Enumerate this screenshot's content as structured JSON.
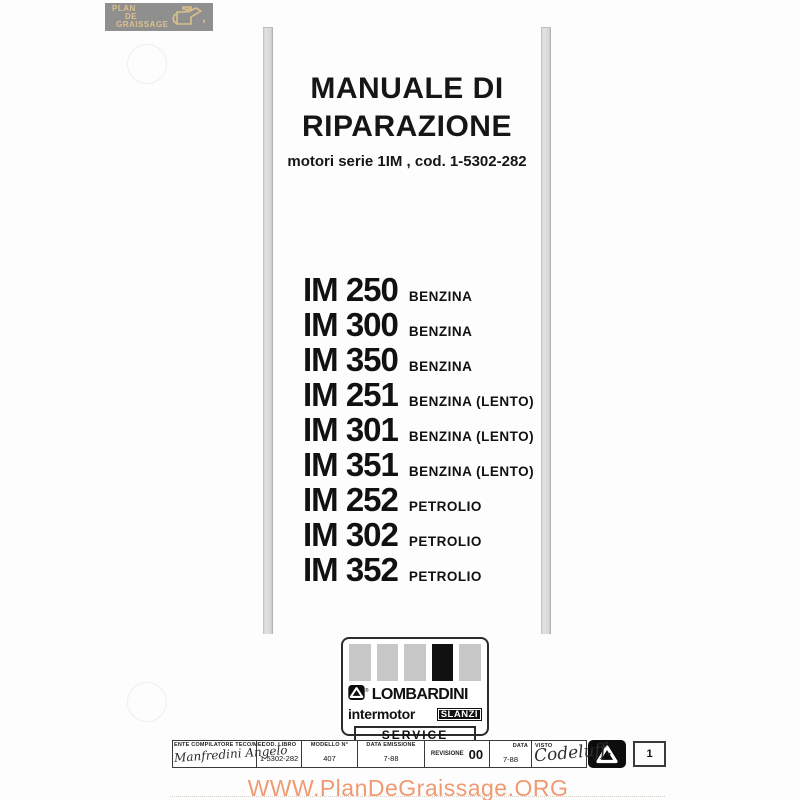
{
  "corner_badge": {
    "line1": "PLAN",
    "line2": "DE",
    "line3": "GRAISSAGE",
    "bg_color": "#8f8f8f",
    "text_color": "#dcc18c",
    "icon": "oil-can-icon"
  },
  "title": {
    "line1": "MANUALE DI",
    "line2": "RIPARAZIONE",
    "subtitle": "motori serie 1IM , cod. 1-5302-282"
  },
  "models": [
    {
      "name": "IM 250",
      "fuel": "BENZINA"
    },
    {
      "name": "IM 300",
      "fuel": "BENZINA"
    },
    {
      "name": "IM 350",
      "fuel": "BENZINA"
    },
    {
      "name": "IM 251",
      "fuel": "BENZINA (LENTO)"
    },
    {
      "name": "IM 301",
      "fuel": "BENZINA (LENTO)"
    },
    {
      "name": "IM 351",
      "fuel": "BENZINA (LENTO)"
    },
    {
      "name": "IM 252",
      "fuel": "PETROLIO"
    },
    {
      "name": "IM 302",
      "fuel": "PETROLIO"
    },
    {
      "name": "IM 352",
      "fuel": "PETROLIO"
    }
  ],
  "brand_block": {
    "brand": "LOMBARDINI",
    "registered": "®",
    "left_brand": "intermotor",
    "right_brand": "SLANZI",
    "service": "SERVICE",
    "bar_colors": [
      "#c7c7c7",
      "#c7c7c7",
      "#c7c7c7",
      "#111111",
      "#c7c7c7"
    ]
  },
  "footer_table": {
    "ente": {
      "label": "ENTE COMPILATORE TECO/MEL",
      "signature": "Manfredini Angelo"
    },
    "cod_libro": {
      "label": "COD. LIBRO",
      "value": "1-5302-282"
    },
    "modello": {
      "label": "MODELLO N°",
      "value": "407"
    },
    "data_emissione": {
      "label": "DATA EMISSIONE",
      "value": "7-88"
    },
    "revisione": {
      "label": "REVISIONE",
      "value": "00"
    },
    "data": {
      "label": "DATA",
      "value": "7-88"
    },
    "visto": {
      "label": "VISTO",
      "signature": "Codeluff."
    },
    "page_number": "1"
  },
  "watermark": {
    "text": "WWW.PlanDeGraissage.ORG",
    "color": "#f09a72"
  }
}
